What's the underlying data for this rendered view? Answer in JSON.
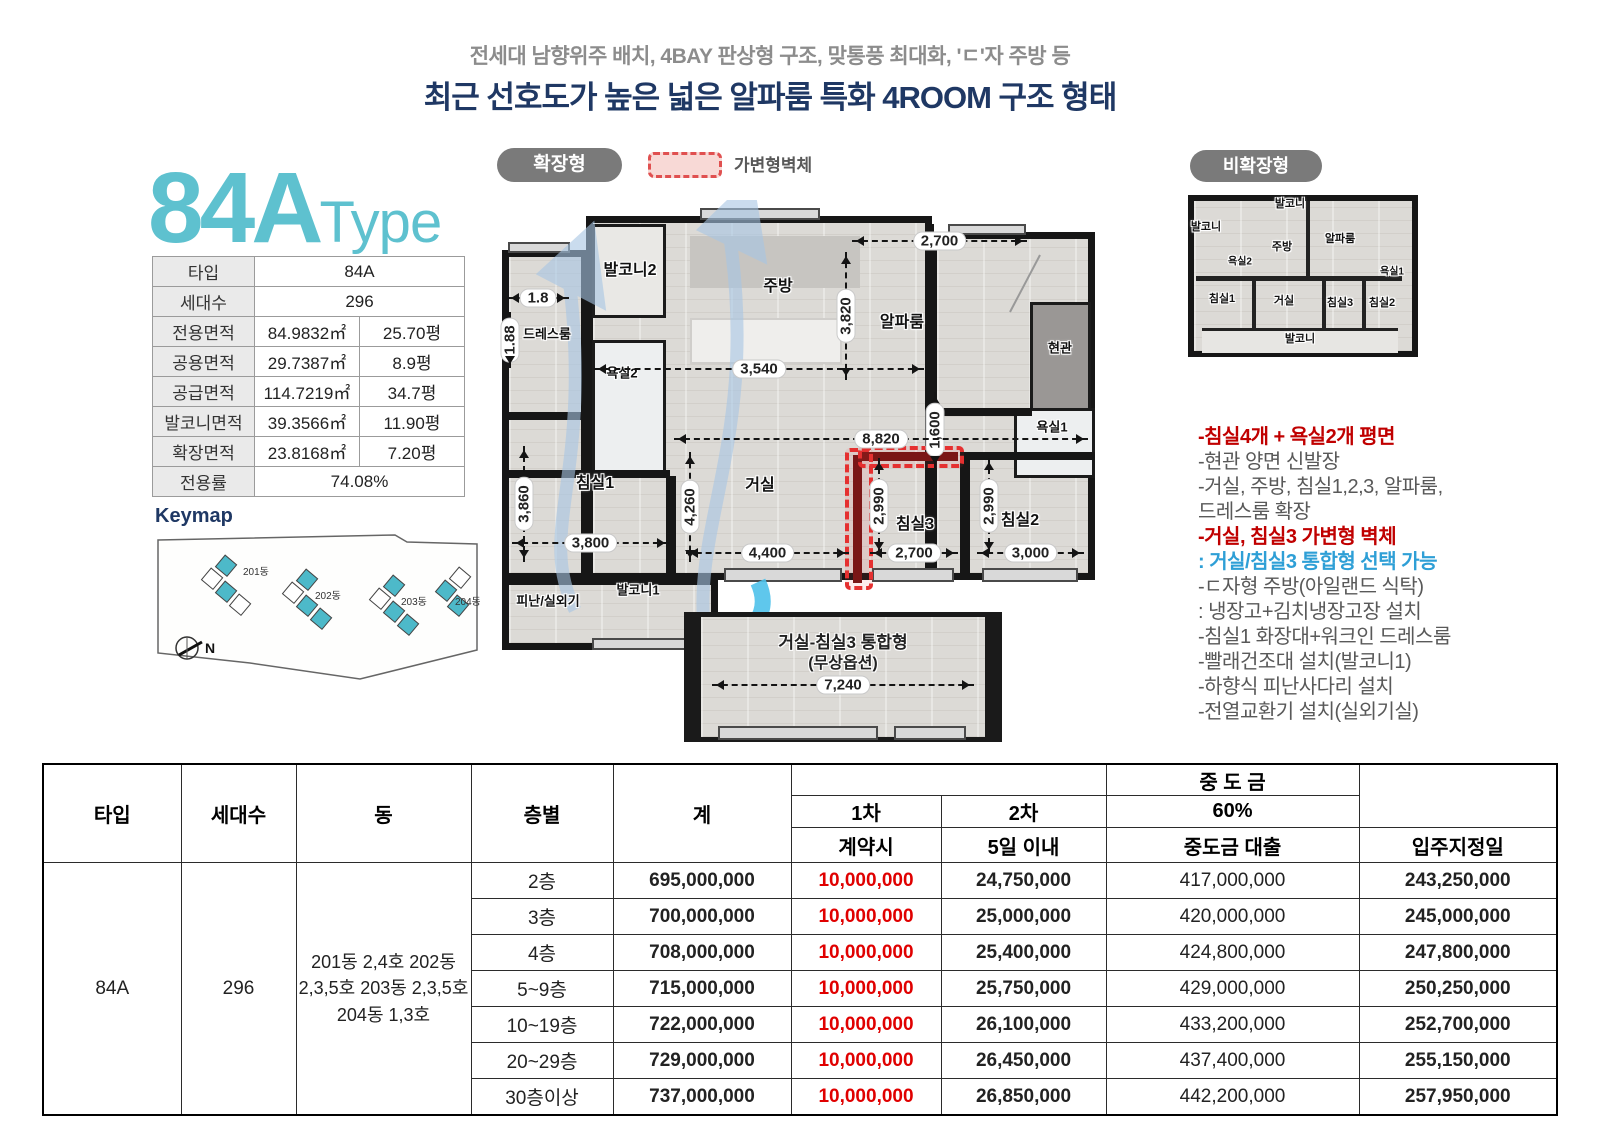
{
  "page": {
    "subtitle": "전세대 남향위주 배치, 4BAY 판상형 구조, 맞통풍 최대화, 'ㄷ'자 주방 등",
    "title": "최근 선호도가 높은 넓은 알파룸 특화 4ROOM 구조 형태"
  },
  "unit": {
    "name": "84A",
    "type_suffix": "Type"
  },
  "spec": {
    "rows": [
      {
        "label": "타입",
        "value": "84A"
      },
      {
        "label": "세대수",
        "value": "296"
      },
      {
        "label": "전용면적",
        "m2": "84.9832㎡",
        "py": "25.70평"
      },
      {
        "label": "공용면적",
        "m2": "29.7387㎡",
        "py": "8.9평"
      },
      {
        "label": "공급면적",
        "m2": "114.7219㎡",
        "py": "34.7평"
      },
      {
        "label": "발코니면적",
        "m2": "39.3566㎡",
        "py": "11.90평"
      },
      {
        "label": "확장면적",
        "m2": "23.8168㎡",
        "py": "7.20평"
      },
      {
        "label": "전용률",
        "value": "74.08%"
      }
    ]
  },
  "keymap": {
    "title": "Keymap",
    "buildings": [
      "201동",
      "202동",
      "203동",
      "204동"
    ],
    "north": "N"
  },
  "plan": {
    "expanded_badge": "확장형",
    "legend_label": "가변형벽체",
    "nonexpanded_badge": "비확장형",
    "rooms": {
      "balcony2": "발코니2",
      "kitchen": "주방",
      "alpha": "알파룸",
      "dress": "드레스룸",
      "bath2": "욕실2",
      "entry": "현관",
      "bath1": "욕실1",
      "bed1": "침실1",
      "living": "거실",
      "bed3": "침실3",
      "bed2": "침실2",
      "balcony1": "발코니1",
      "escape": "피난/실외기"
    },
    "dims": {
      "alpha_w": "2,700",
      "alpha_h": "3,820",
      "dress_w": "1.8",
      "dress_h": "1.88",
      "kitchen_w": "3,540",
      "entry_h": "1,600",
      "total_w": "8,820",
      "bed1_h": "3,860",
      "bed1_w": "3,800",
      "living_h": "4,260",
      "living_w": "4,400",
      "bed3_h": "2,990",
      "bed3_w": "2,700",
      "bed2_h": "2,990",
      "bed2_w": "3,000"
    },
    "subplan": {
      "line1": "거실-침실3 통합형",
      "line2": "(무상옵션)",
      "dim": "7,240"
    },
    "small": {
      "bal_top": "발코니",
      "bal_left": "발코니",
      "kitchen": "주방",
      "alpha": "알파룸",
      "bath2": "욕실2",
      "bath1": "욕실1",
      "bed1": "침실1",
      "living": "거실",
      "bed3": "침실3",
      "bed2": "침실2",
      "bal_bottom": "발코니"
    }
  },
  "features": [
    {
      "text": "-침실4개 + 욕실2개 평면"
    },
    {
      "text": "-현관 양면 신발장"
    },
    {
      "text": "-거실, 주방, 침실1,2,3, 알파룸,"
    },
    {
      "text": "드레스룸 확장"
    },
    {
      "text": "-거실, 침실3 가변형 벽체"
    },
    {
      "text": ": 거실/침실3 통합형 선택 가능"
    },
    {
      "text": "-ㄷ자형 주방(아일랜드 식탁)"
    },
    {
      "text": ": 냉장고+김치냉장고장 설치"
    },
    {
      "text": "-침실1 화장대+워크인 드레스룸"
    },
    {
      "text": "-빨래건조대 설치(발코니1)"
    },
    {
      "text": "-하향식 피난사다리 설치"
    },
    {
      "text": "-전열교환기 설치(실외기실)"
    }
  ],
  "price": {
    "headers": {
      "type": "타입",
      "units": "세대수",
      "dong": "동",
      "floor": "층별",
      "total": "계",
      "deposit": "계약금 (5%)",
      "interim": "중 도 금",
      "balance": "잔금 (35%)",
      "d1": "1차",
      "d2": "2차",
      "i60": "60%",
      "d1s": "계약시",
      "d2s": "5일 이내",
      "iloan": "중도금 대출",
      "bdate": "입주지정일"
    },
    "row": {
      "type": "84A",
      "units": "296",
      "dong": "201동 2,4호 202동 2,3,5호 203동 2,3,5호 204동 1,3호"
    },
    "floors": [
      {
        "floor": "2층",
        "total": "695,000,000",
        "p1": "10,000,000",
        "p2": "24,750,000",
        "loan": "417,000,000",
        "bal": "243,250,000"
      },
      {
        "floor": "3층",
        "total": "700,000,000",
        "p1": "10,000,000",
        "p2": "25,000,000",
        "loan": "420,000,000",
        "bal": "245,000,000"
      },
      {
        "floor": "4층",
        "total": "708,000,000",
        "p1": "10,000,000",
        "p2": "25,400,000",
        "loan": "424,800,000",
        "bal": "247,800,000"
      },
      {
        "floor": "5~9층",
        "total": "715,000,000",
        "p1": "10,000,000",
        "p2": "25,750,000",
        "loan": "429,000,000",
        "bal": "250,250,000"
      },
      {
        "floor": "10~19층",
        "total": "722,000,000",
        "p1": "10,000,000",
        "p2": "26,100,000",
        "loan": "433,200,000",
        "bal": "252,700,000"
      },
      {
        "floor": "20~29층",
        "total": "729,000,000",
        "p1": "10,000,000",
        "p2": "26,450,000",
        "loan": "437,400,000",
        "bal": "255,150,000"
      },
      {
        "floor": "30층이상",
        "total": "737,000,000",
        "p1": "10,000,000",
        "p2": "26,850,000",
        "loan": "442,200,000",
        "bal": "257,950,000"
      }
    ]
  },
  "colors": {
    "accent_cyan": "#5ec1cf",
    "navy": "#1f3864",
    "header_red": "#fe0000",
    "header_blue": "#8faadc",
    "pink": "#f3dcdb",
    "light_blue": "#dbe5f1",
    "feature_red": "#c00000",
    "feature_blue": "#2e9fd6",
    "price_red": "#e00000"
  }
}
